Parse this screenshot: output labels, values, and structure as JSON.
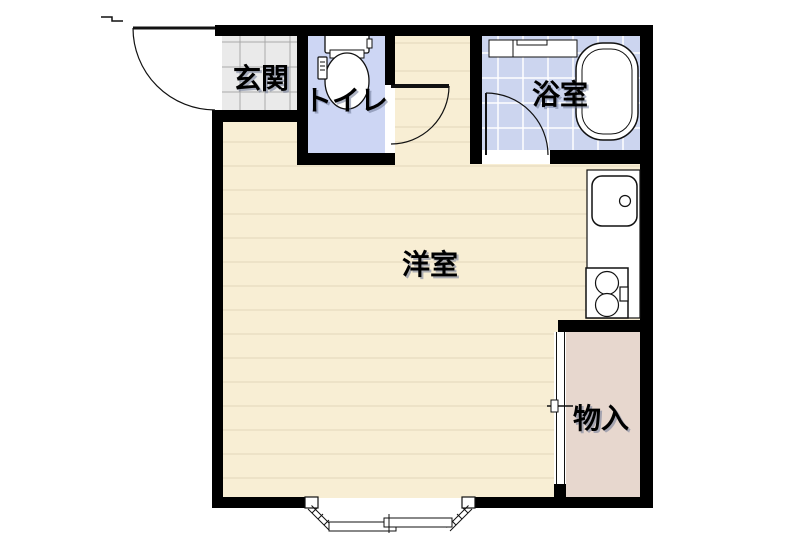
{
  "labels": {
    "genkan": "玄関",
    "toilet": "トイレ",
    "bathroom": "浴室",
    "main_room": "洋室",
    "storage": "物入"
  },
  "colors": {
    "wall": "#000000",
    "room_floor": "#f8eed4",
    "floor_line": "#e2d7ba",
    "genkan_tile": "#eaeaea",
    "genkan_grout": "#a9a9a9",
    "toilet_floor": "#cdd6f4",
    "bath_floor": "#ccd5ef",
    "bath_tile_line": "#ffffff",
    "storage_floor": "#e7d7ce",
    "fixture_outline": "#111111"
  },
  "fixtures": {
    "entrance_door": "hinged entry door swinging outward",
    "toilet": "toilet with tank and washlet panel",
    "toilet_door": "hinged door",
    "bath_vanity": "vanity counter",
    "bathtub": "bathtub",
    "bath_door": "hinged door",
    "kitchen_sink": "sink with faucet",
    "stove": "two-burner stove",
    "closet_door": "sliding closet door",
    "bay_window": "bay window with sliding sash"
  }
}
